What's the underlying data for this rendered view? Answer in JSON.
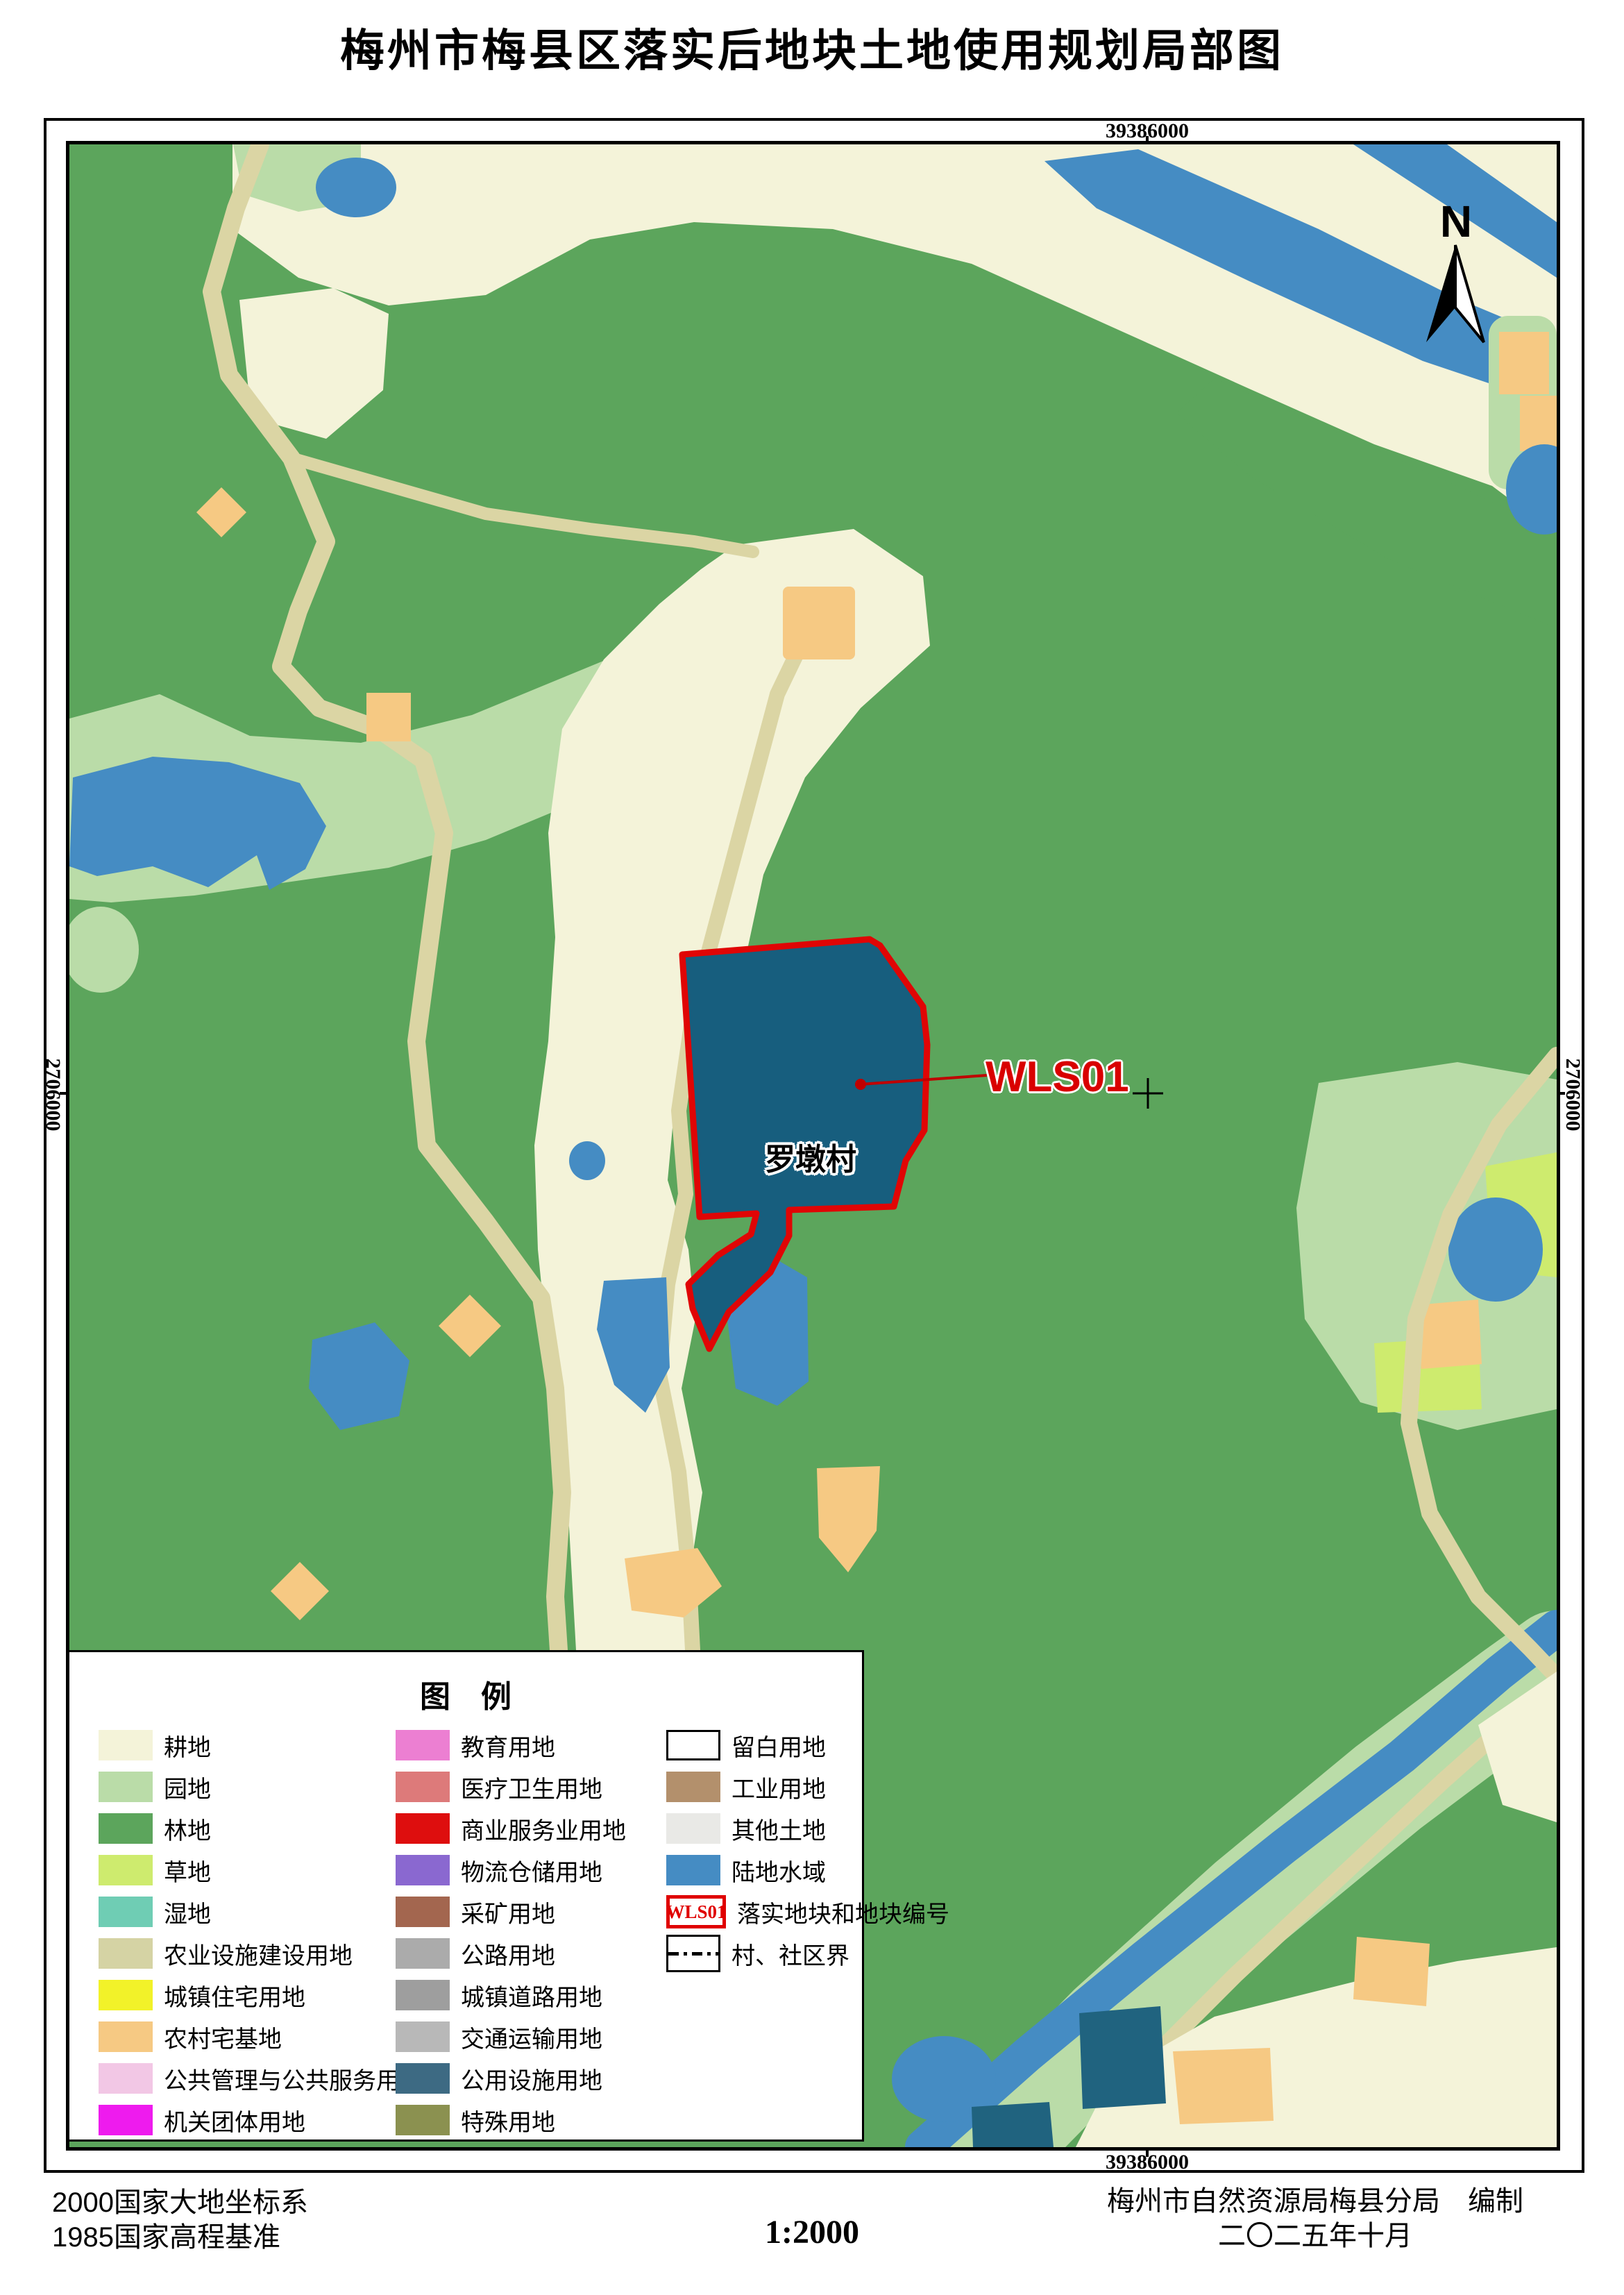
{
  "title": "梅州市梅县区落实后地块土地使用规划局部图",
  "map": {
    "coord_top": "39386000",
    "coord_bottom": "39386000",
    "coord_left": "2706000",
    "coord_right": "2706000",
    "north_label": "N",
    "parcel_code": "WLS01",
    "village_label": "罗墩村"
  },
  "legend": {
    "title": "图　例",
    "wls_code": "WLS01",
    "columns": [
      [
        {
          "label": "耕地",
          "swatch": "color",
          "color": "#F4F3D9"
        },
        {
          "label": "园地",
          "swatch": "color",
          "color": "#BADCA8"
        },
        {
          "label": "林地",
          "swatch": "color",
          "color": "#5CA55C"
        },
        {
          "label": "草地",
          "swatch": "color",
          "color": "#CEEB6E"
        },
        {
          "label": "湿地",
          "swatch": "color",
          "color": "#6FCDB4"
        },
        {
          "label": "农业设施建设用地",
          "swatch": "color",
          "color": "#D5D3A4"
        },
        {
          "label": "城镇住宅用地",
          "swatch": "color",
          "color": "#F2F229"
        },
        {
          "label": "农村宅基地",
          "swatch": "color",
          "color": "#F6C983"
        },
        {
          "label": "公共管理与公共服务用地",
          "swatch": "color",
          "color": "#F2C7E5"
        },
        {
          "label": "机关团体用地",
          "swatch": "color",
          "color": "#EE1BEE"
        }
      ],
      [
        {
          "label": "教育用地",
          "swatch": "color",
          "color": "#EC7FD2"
        },
        {
          "label": "医疗卫生用地",
          "swatch": "color",
          "color": "#DD7A7A"
        },
        {
          "label": "商业服务业用地",
          "swatch": "color",
          "color": "#DE0E0E"
        },
        {
          "label": "物流仓储用地",
          "swatch": "color",
          "color": "#8A68D0"
        },
        {
          "label": "采矿用地",
          "swatch": "color",
          "color": "#A3664F"
        },
        {
          "label": "公路用地",
          "swatch": "color",
          "color": "#ABABAB"
        },
        {
          "label": "城镇道路用地",
          "swatch": "color",
          "color": "#9E9E9E"
        },
        {
          "label": "交通运输用地",
          "swatch": "color",
          "color": "#B8B8B8"
        },
        {
          "label": "公用设施用地",
          "swatch": "color",
          "color": "#3D6A83"
        },
        {
          "label": "特殊用地",
          "swatch": "color",
          "color": "#8B9150"
        }
      ],
      [
        {
          "label": "留白用地",
          "swatch": "outline"
        },
        {
          "label": "工业用地",
          "swatch": "color",
          "color": "#B3906C"
        },
        {
          "label": "其他土地",
          "swatch": "color",
          "color": "#E9E9E6"
        },
        {
          "label": "陆地水域",
          "swatch": "color",
          "color": "#458CC3"
        },
        {
          "label": "落实地块和地块编号",
          "swatch": "wls"
        },
        {
          "label": "村、社区界",
          "swatch": "dashed"
        }
      ]
    ]
  },
  "footer": {
    "datum_line1": "2000国家大地坐标系",
    "datum_line2": "1985国家高程基准",
    "scale": "1:2000",
    "publisher": "梅州市自然资源局梅县分局　编制",
    "date": "二〇二五年十月"
  },
  "colors": {
    "forest": "#5CA55C",
    "cropland": "#F4F3D9",
    "orchard": "#BADCA8",
    "water": "#458CC3",
    "road": "#DBD5A4",
    "rural_housing": "#F6C983",
    "grass": "#CEEB6E",
    "utility_teal": "#20637F",
    "parcel_fill": "#175E7E",
    "parcel_stroke": "#E00505",
    "annotation_red": "#D90000"
  }
}
